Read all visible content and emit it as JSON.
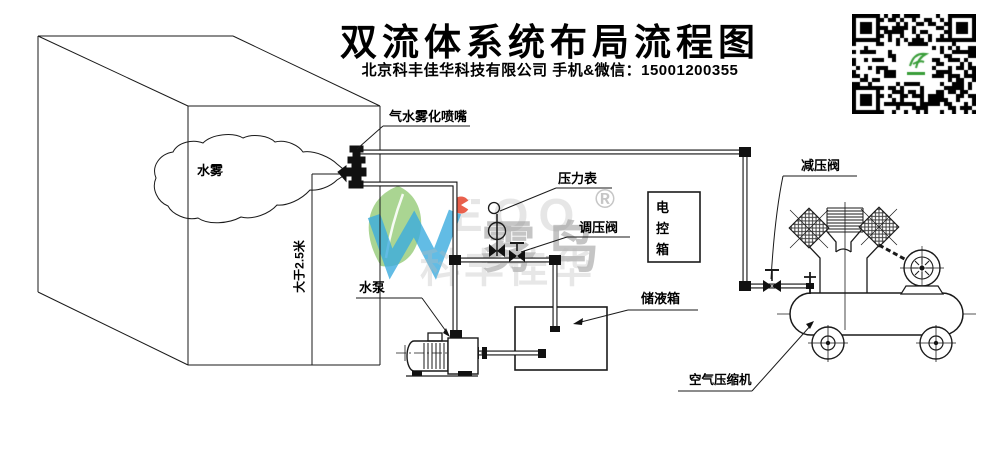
{
  "header": {
    "title": "双流体系统布局流程图",
    "subtitle": "北京科丰佳华科技有限公司 手机&微信：15001200355"
  },
  "diagram": {
    "labels": {
      "nozzle": "气水雾化喷嘴",
      "mist": "水雾",
      "pressure_gauge": "压力表",
      "regulating_valve": "调压阀",
      "control_box": "电控箱",
      "reducing_valve": "减压阀",
      "water_pump": "水泵",
      "storage_tank": "储液箱",
      "air_compressor": "空气压缩机",
      "height_dimension": "大于2.5米"
    }
  },
  "watermark": {
    "brand": "雾鸟",
    "company": "科丰佳华",
    "letters": "EOO",
    "registered": "®",
    "colors": {
      "leaf_green": "#9BCE7F",
      "logo_blue": "#3BABDF",
      "logo_red": "#E8503A",
      "gray": "#ABABAB"
    }
  },
  "qr": {
    "label": "wechat-qr-code",
    "center_icon": "green-bird-logo"
  }
}
